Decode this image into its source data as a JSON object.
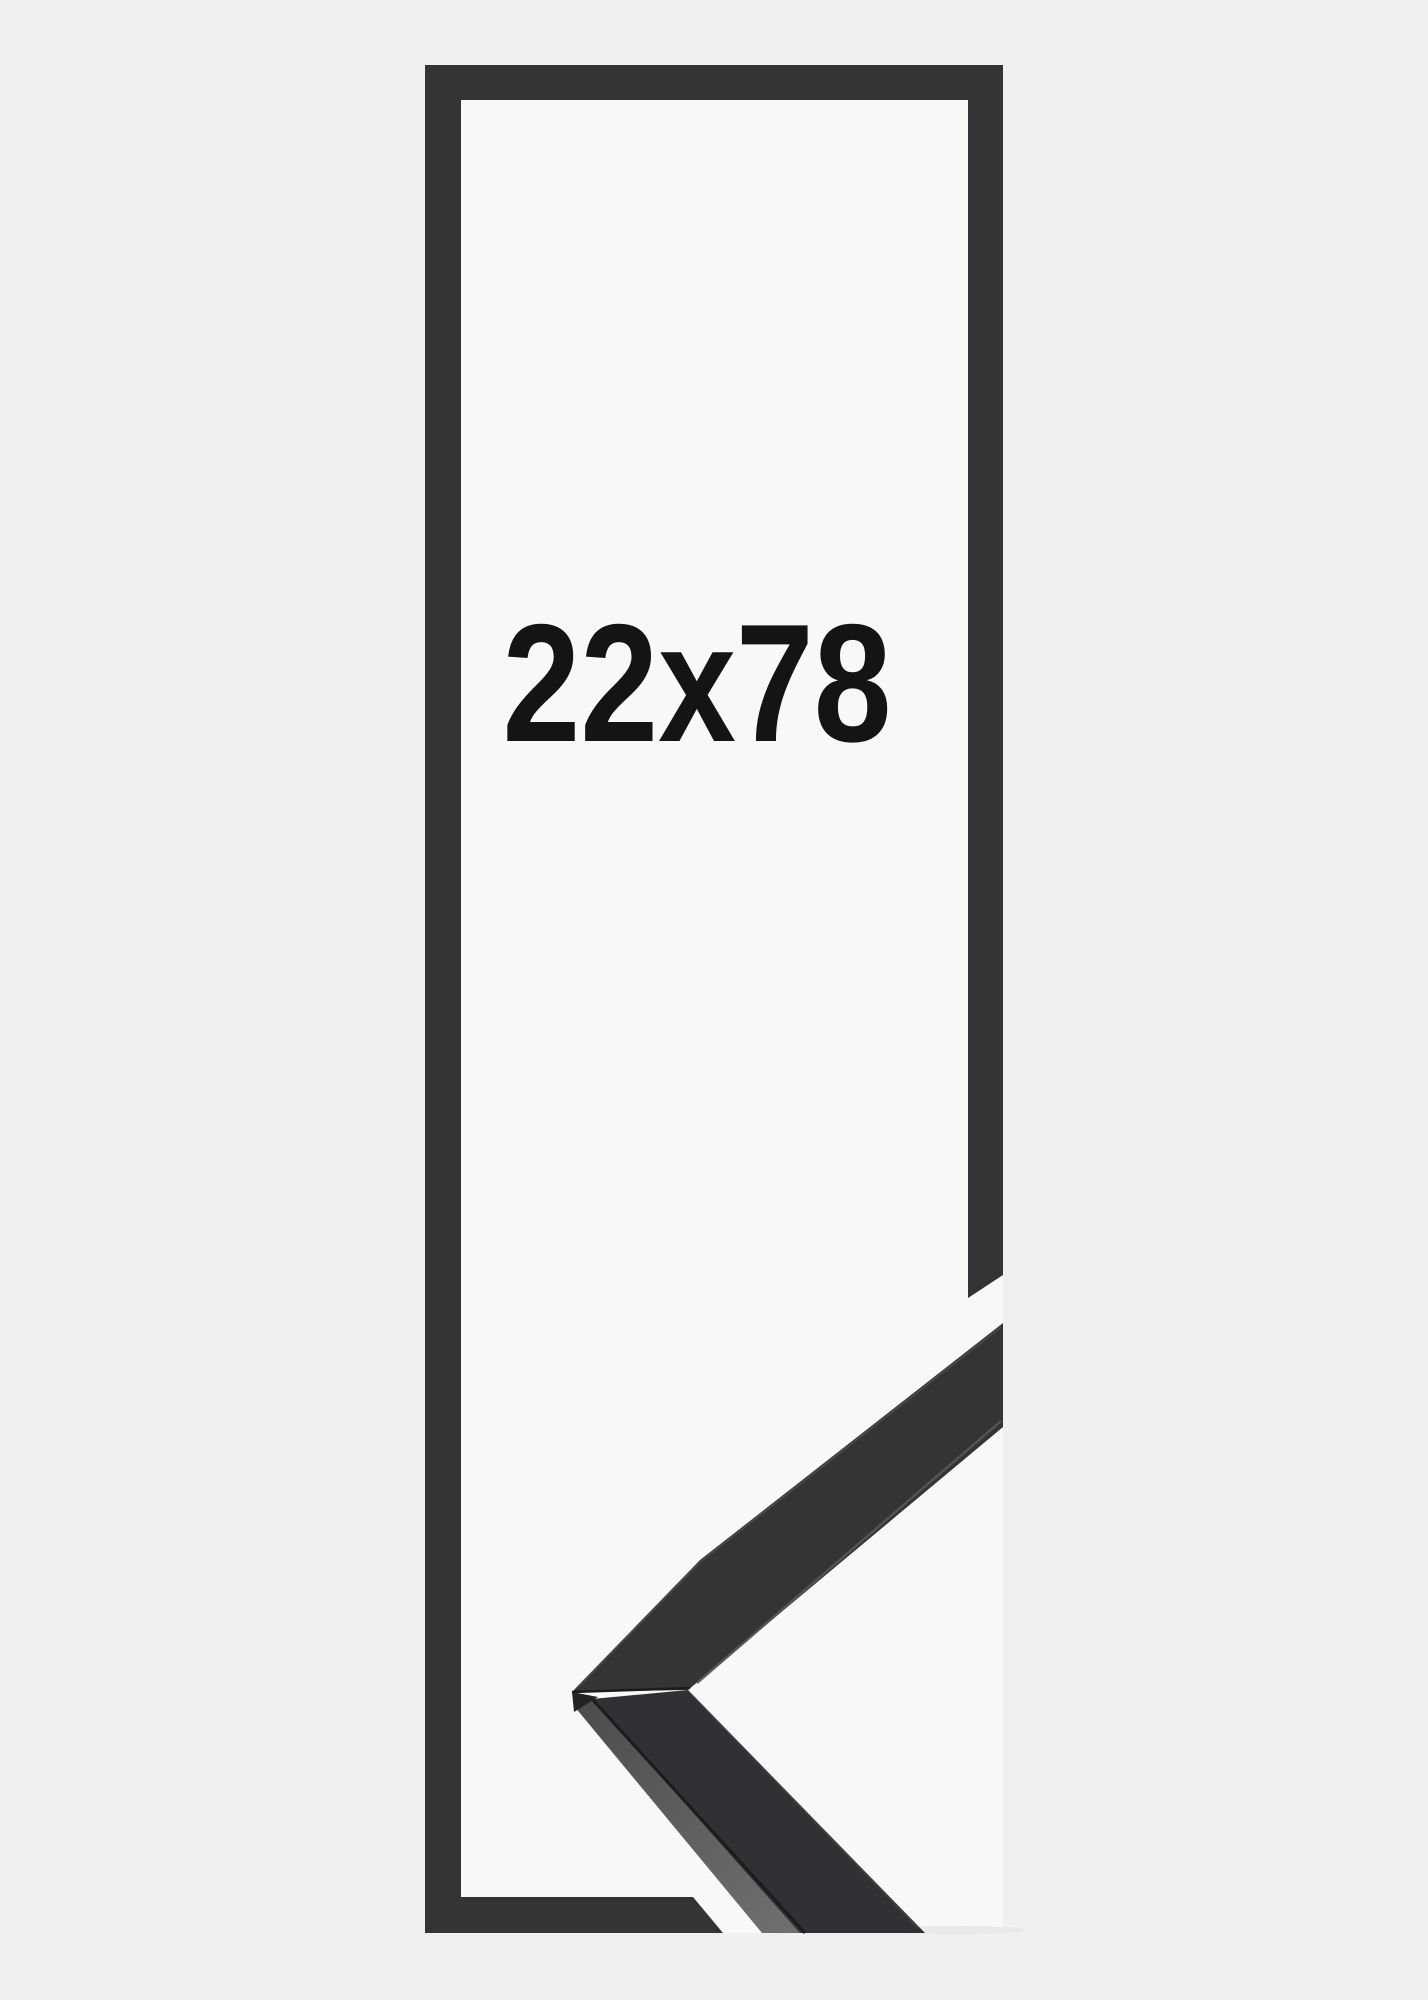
{
  "page": {
    "background": "#f0f0f1"
  },
  "product_image": {
    "size_label": "22x78",
    "label_color": "#141414",
    "canvas_background": "#f8f8f8",
    "frame_outline_color": "#323436",
    "corner_sample": {
      "top_face": "#343437",
      "lower_face": "#303134",
      "bevel_light": "#6f6f6f",
      "bevel_dark": "#4d4d4f",
      "crease": "#1c1c1e",
      "seam": "#1c1c1e",
      "edge_highlight": "#56565a",
      "rim_highlight": "#4c4c4f",
      "lower_edge_highlight": "#47474a",
      "depth_face": "#232326",
      "shadow": "#e2e2e3"
    }
  }
}
